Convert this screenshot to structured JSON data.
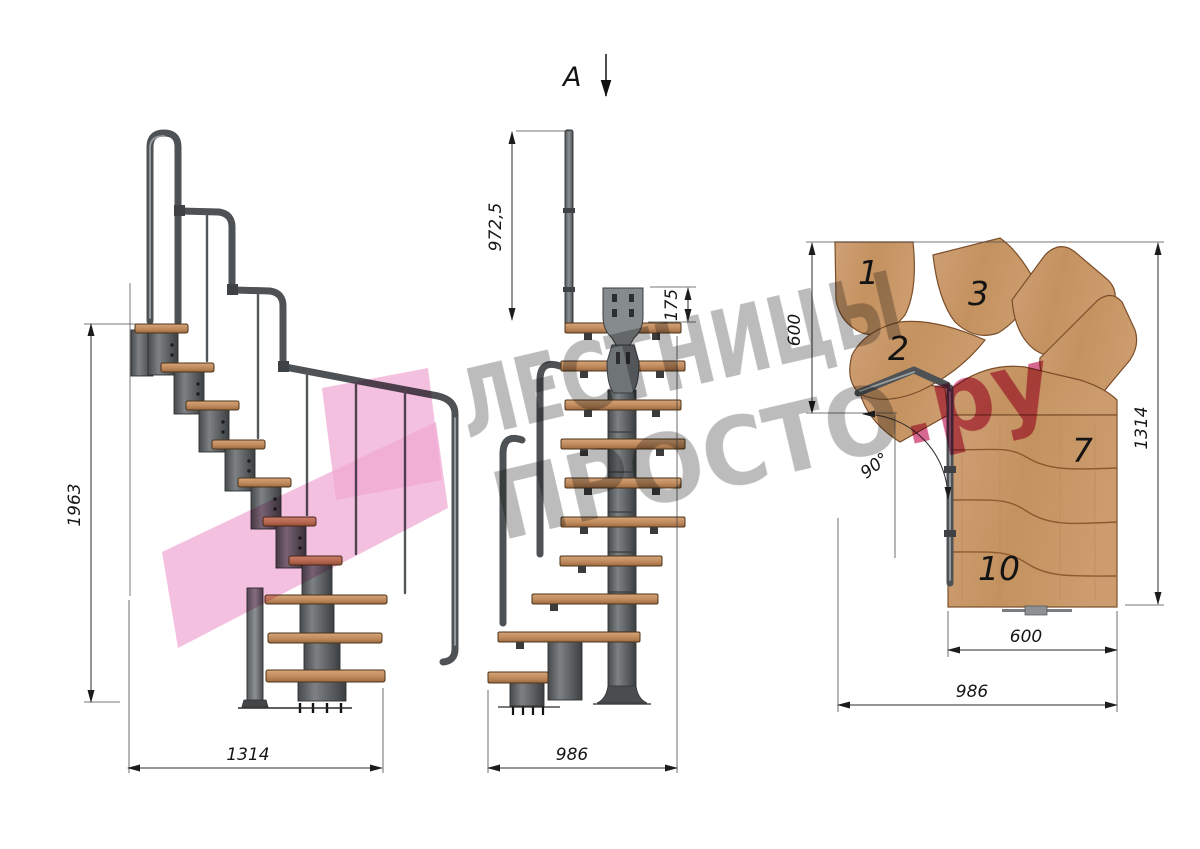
{
  "watermark": {
    "line1": "ЛЕСТНИЦЫ",
    "line2_gray": "ПРОСТО",
    "line2_pink": ".ру",
    "gray_color": "#8f8f8f",
    "pink_color": "#c9356b",
    "logo_color": "#f0a8d2"
  },
  "section_arrow": {
    "label": "A"
  },
  "side_view": {
    "title": "side-elevation",
    "height_dim": "1963",
    "length_dim": "1314"
  },
  "front_view": {
    "title": "front-elevation",
    "rail_height_dim": "972,5",
    "plate_dim": "175",
    "width_dim": "986"
  },
  "plan_view": {
    "title": "plan-view",
    "top_depth_dim": "600",
    "height_dim": "1314",
    "flight_width_dim": "600",
    "total_width_dim": "986",
    "angle_dim": "90°",
    "step_labels": [
      "1",
      "2",
      "3",
      "7",
      "10"
    ]
  },
  "colors": {
    "wood": "#c9996f",
    "wood_edge": "#5f4026",
    "metal": "#5d6163",
    "dim_line": "#2b2b2b"
  }
}
